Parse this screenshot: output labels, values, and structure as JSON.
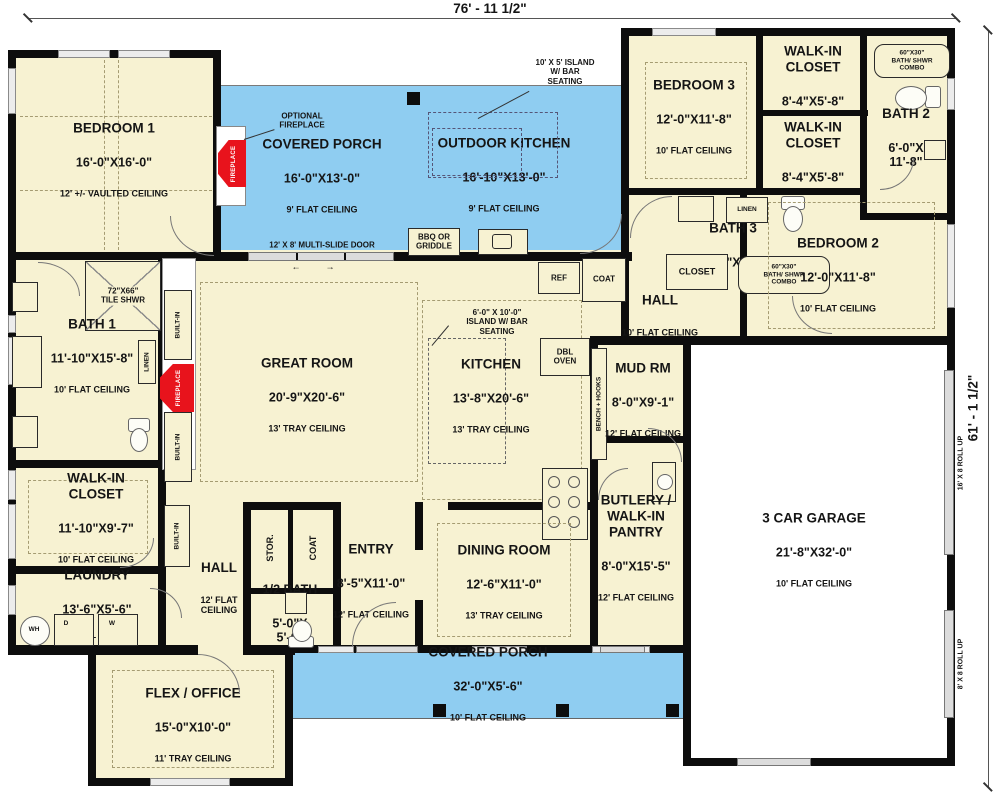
{
  "dimensions": {
    "width_label": "76' - 11 1/2\"",
    "height_label": "61' - 1 1/2\""
  },
  "rooms": {
    "bedroom1": {
      "name": "BEDROOM 1",
      "dims": "16'-0\"X16'-0\"",
      "ceiling": "12' +/- VAULTED CEILING"
    },
    "porch_top": {
      "name": "COVERED PORCH",
      "dims": "16'-0\"X13'-0\"",
      "ceiling": "9' FLAT CEILING"
    },
    "outdoor_kitchen": {
      "name": "OUTDOOR KITCHEN",
      "dims": "16'-10\"X13'-0\"",
      "ceiling": "9' FLAT CEILING"
    },
    "bedroom3": {
      "name": "BEDROOM 3",
      "dims": "12'-0\"X11'-8\"",
      "ceiling": "10' FLAT CEILING"
    },
    "wic_small": {
      "name": "WALK-IN\nCLOSET",
      "dims": "8'-4\"X5'-8\""
    },
    "bath2": {
      "name": "BATH 2",
      "dims": "6'-0\"X\n11'-8\""
    },
    "bath3": {
      "name": "BATH 3",
      "dims": "9'-10\"X7'-8\""
    },
    "bedroom2": {
      "name": "BEDROOM 2",
      "dims": "12'-0\"X11'-8\"",
      "ceiling": "10' FLAT CEILING"
    },
    "hall_right": {
      "name": "HALL",
      "ceiling": "10' FLAT CEILING"
    },
    "great_room": {
      "name": "GREAT ROOM",
      "dims": "20'-9\"X20'-6\"",
      "ceiling": "13' TRAY CEILING"
    },
    "kitchen": {
      "name": "KITCHEN",
      "dims": "13'-8\"X20'-6\"",
      "ceiling": "13' TRAY CEILING"
    },
    "bath1": {
      "name": "BATH 1",
      "dims": "11'-10\"X15'-8\"",
      "ceiling": "10' FLAT CEILING"
    },
    "wic_left": {
      "name": "WALK-IN\nCLOSET",
      "dims": "11'-10\"X9'-7\"",
      "ceiling": "10' FLAT CEILING"
    },
    "laundry": {
      "name": "LAUNDRY",
      "dims": "13'-6\"X5'-6\"",
      "ceiling": "10' FLAT CEILING"
    },
    "hall_left": {
      "name": "HALL",
      "ceiling": "12' FLAT\nCEILING"
    },
    "mud_rm": {
      "name": "MUD RM",
      "dims": "8'-0\"X9'-1\"",
      "ceiling": "12' FLAT CEILING"
    },
    "butlery": {
      "name": "BUTLERY /\nWALK-IN\nPANTRY",
      "dims": "8'-0\"X15'-5\"",
      "ceiling": "12' FLAT CEILING"
    },
    "entry": {
      "name": "ENTRY",
      "dims": "8'-5\"X11'-0\"",
      "ceiling": "12' FLAT CEILING"
    },
    "half_bath": {
      "name": "1/2 BATH",
      "dims": "5'-0\"X\n5'-6\""
    },
    "dining": {
      "name": "DINING ROOM",
      "dims": "12'-6\"X11'-0\"",
      "ceiling": "13' TRAY CEILING"
    },
    "garage": {
      "name": "3 CAR GARAGE",
      "dims": "21'-8\"X32'-0\"",
      "ceiling": "10' FLAT CEILING"
    },
    "flex": {
      "name": "FLEX / OFFICE",
      "dims": "15'-0\"X10'-0\"",
      "ceiling": "11' TRAY CEILING"
    },
    "porch_bottom": {
      "name": "COVERED PORCH",
      "dims": "32'-0\"X5'-6\"",
      "ceiling": "10' FLAT CEILING"
    }
  },
  "annotations": {
    "optional_fireplace": "OPTIONAL\nFIREPLACE",
    "outdoor_island": "10' X 5' ISLAND\nW/ BAR\nSEATING",
    "kitchen_island": "6'-0\" X 10'-0\"\nISLAND W/ BAR\nSEATING",
    "multi_slide": "12' X 8' MULTI-SLIDE DOOR",
    "arrow_left": "←",
    "arrow_right": "→",
    "bbq": "BBQ OR\nGRIDDLE",
    "tile_shwr": "72\"X66\"\nTILE SHWR",
    "shwr_combo": "60\"X30\"\nBATH/ SHWR\nCOMBO",
    "linen": "LINEN",
    "closet": "CLOSET",
    "stor": "STOR.",
    "coat": "COAT",
    "ref": "REF",
    "dbl_oven": "DBL\nOVEN",
    "bench_hooks": "BENCH + HOOKS",
    "built_in": "BUILT-IN",
    "fireplace": "FIREPLACE",
    "wh": "WH",
    "dryer": "D",
    "washer": "W",
    "roll_up_16": "16' X 8 ROLL UP",
    "roll_up_8": "8' X 8 ROLL UP"
  },
  "colors": {
    "room_fill": "#f7f2d2",
    "porch_fill": "#8fcdf1",
    "wall": "#0d0d0d",
    "fireplace_red": "#e8131c",
    "garage_fill": "#ffffff"
  }
}
